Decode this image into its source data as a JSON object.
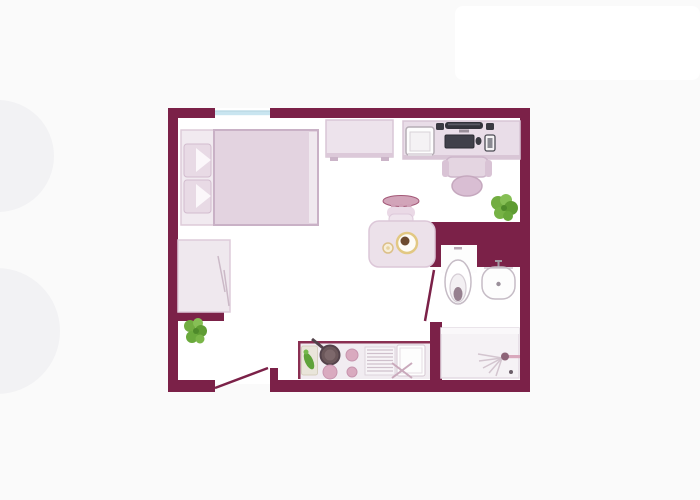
{
  "palette": {
    "bg": "#fafafa",
    "panel": "#ffffff",
    "wall": "#7b2148",
    "wall-accent": "#8a2f52",
    "floor": "#ffffff",
    "pink-light": "#ece1ea",
    "pink-mid": "#e3d3e0",
    "pink-border": "#d8c4d4",
    "pink-deep": "#d9bed3",
    "window-blue": "#c9e5f0",
    "window-line": "#a3cddd",
    "green": "#72ad41",
    "green-dark": "#5f9c33",
    "green-light": "#86bf55",
    "device-dark": "#3a3a42",
    "fixture-border": "#c6bcc6",
    "lid": "#96808f",
    "pan": "#6b575a",
    "burner": "#d9aabf",
    "food-yellow": "#e2c883",
    "spray": "#d3c5cf"
  },
  "floorplan": {
    "type": "studio-apartment-top-view",
    "rooms": [
      "main-room",
      "bathroom",
      "shower-corner",
      "kitchenette",
      "entry"
    ],
    "openings": [
      "window-top-wall",
      "entry-door-bottom-wall",
      "bathroom-door"
    ],
    "furniture": [
      "double-bed",
      "pillow",
      "pillow",
      "wardrobe",
      "dresser",
      "desk",
      "printer",
      "speaker",
      "monitor",
      "speaker",
      "keyboard",
      "mouse",
      "smartphone",
      "office-chair",
      "dining-chair",
      "dining-table",
      "plate",
      "cup",
      "toilet",
      "wash-basin",
      "shower-tray",
      "shower-head",
      "kitchen-counter",
      "cutting-board",
      "vegetables",
      "frying-pan",
      "stove-burner",
      "stove-burner",
      "stove-burner",
      "drainboard",
      "kitchen-sink",
      "faucet",
      "potted-plant",
      "potted-plant"
    ]
  }
}
